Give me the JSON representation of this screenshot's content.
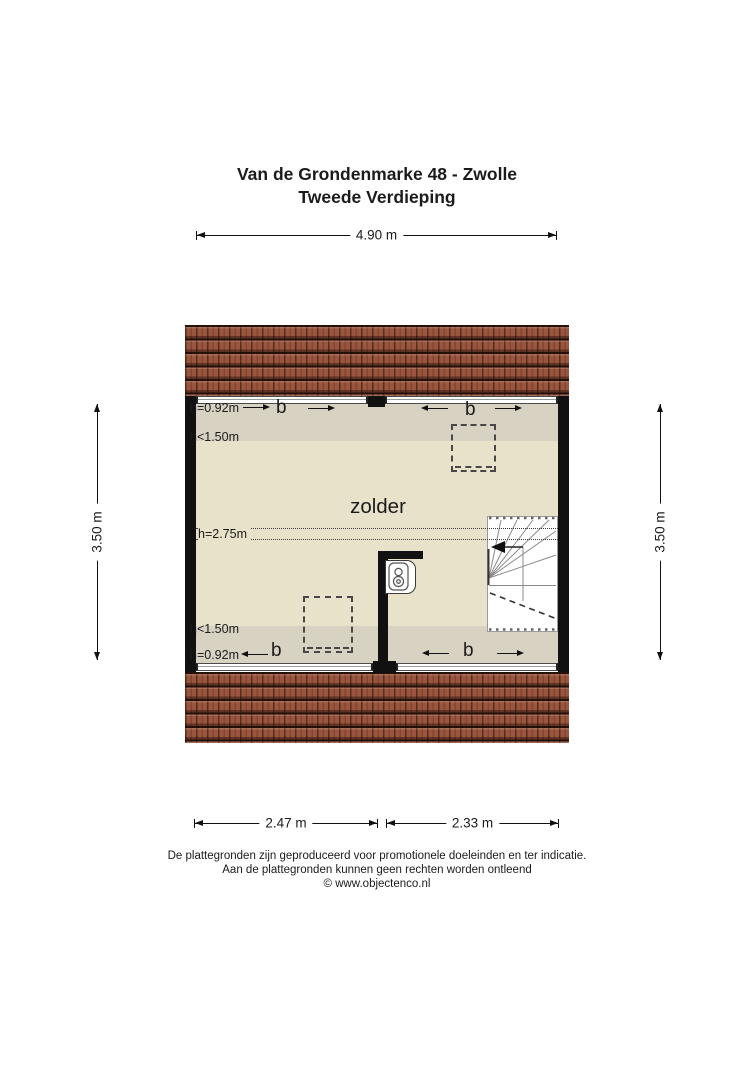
{
  "title": {
    "line1": "Van de Grondenmarke 48 - Zwolle",
    "line2": "Tweede Verdieping"
  },
  "room_label": "zolder",
  "dimensions": {
    "top": "4.90 m",
    "left": "3.50 m",
    "right": "3.50 m",
    "bottom_left": "2.47 m",
    "bottom_right": "2.33 m"
  },
  "height_labels": {
    "top_ridge": "h=0.92m",
    "top_low": "h<1.50m",
    "middle": "h=2.75m",
    "bottom_low": "h<1.50m",
    "bottom_ridge": "h=0.92m"
  },
  "window_labels": {
    "top_left": "b",
    "top_right": "b",
    "bottom_left": "b",
    "bottom_right": "b"
  },
  "footer": {
    "line1": "De plattegronden zijn geproduceerd voor promotionele doeleinden en ter indicatie.",
    "line2": "Aan de plattegronden kunnen geen rechten worden ontleend",
    "line3": "© www.objectenco.nl"
  },
  "colors": {
    "roof": "#99553e",
    "floor": "#e8e2cb",
    "floor_low_height": "#d8d2c2",
    "wall": "#111111",
    "stairs": "#ffffff"
  }
}
